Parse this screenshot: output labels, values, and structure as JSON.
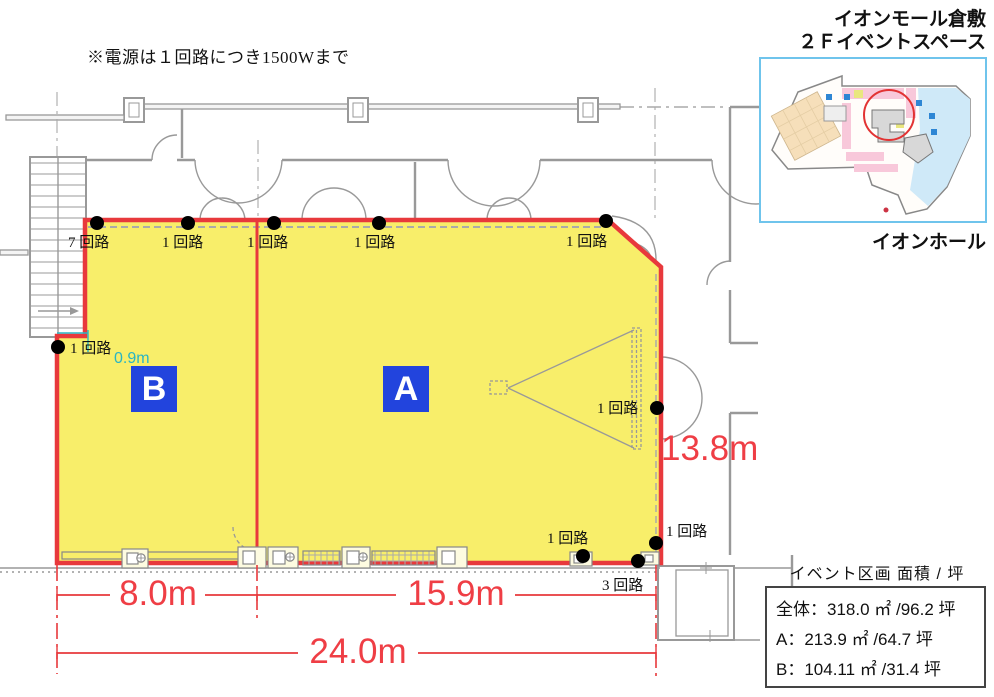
{
  "note": "※電源は１回路につき1500Wまで",
  "map": {
    "title_line1": "イオンモール倉敷",
    "title_line2": "２Ｆイベントスペース",
    "caption": "イオンホール"
  },
  "zones": {
    "a": "A",
    "b": "B"
  },
  "circuits": {
    "top": [
      "7 回路",
      "1 回路",
      "1 回路",
      "1 回路",
      "1 回路"
    ],
    "left": "1 回路",
    "right": "1 回路",
    "bottom": [
      "1 回路",
      "1 回路",
      "3 回路"
    ]
  },
  "dimensions": {
    "b_width": "8.0m",
    "a_width": "15.9m",
    "total_width": "24.0m",
    "height": "13.8m",
    "offset": "0.9m"
  },
  "info_box": {
    "title": "イベント区画 面積 / 坪",
    "rows": [
      "全体：318.0 ㎡ /96.2 坪",
      "A：213.9 ㎡ /64.7 坪",
      "B：104.11 ㎡ /31.4 坪"
    ]
  },
  "colors": {
    "highlight_fill": "#f8ee6a",
    "outline_red": "#e8393c",
    "dimension_red": "#ef3e45",
    "offset_teal": "#2ab5c3",
    "zone_label_bg": "#2244dd",
    "map_border_blue": "#6fc4ec"
  }
}
